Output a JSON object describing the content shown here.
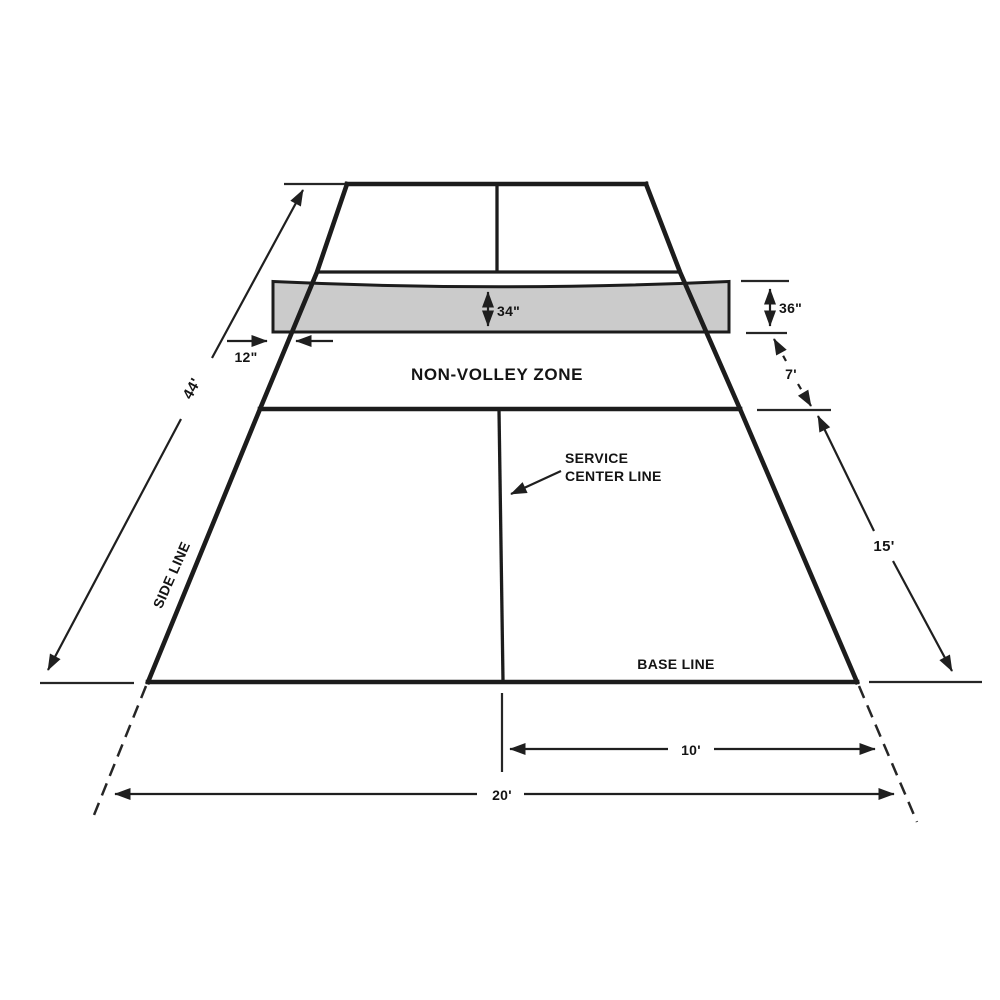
{
  "labels": {
    "non_volley_zone": "NON-VOLLEY ZONE",
    "service_callout_line1": "SERVICE",
    "service_callout_line2": "CENTER LINE",
    "side_line": "SIDE LINE",
    "base_line": "BASE LINE"
  },
  "dimensions": {
    "net_height_center": "34\"",
    "net_height_post": "36\"",
    "post_offset": "12\"",
    "court_length": "44'",
    "non_volley_zone_depth": "7'",
    "service_area_depth": "15'",
    "half_court_width": "10'",
    "court_width": "20'"
  },
  "colors": {
    "line": "#1c1c1c",
    "net_fill": "#cbcbcb",
    "background": "#ffffff"
  }
}
